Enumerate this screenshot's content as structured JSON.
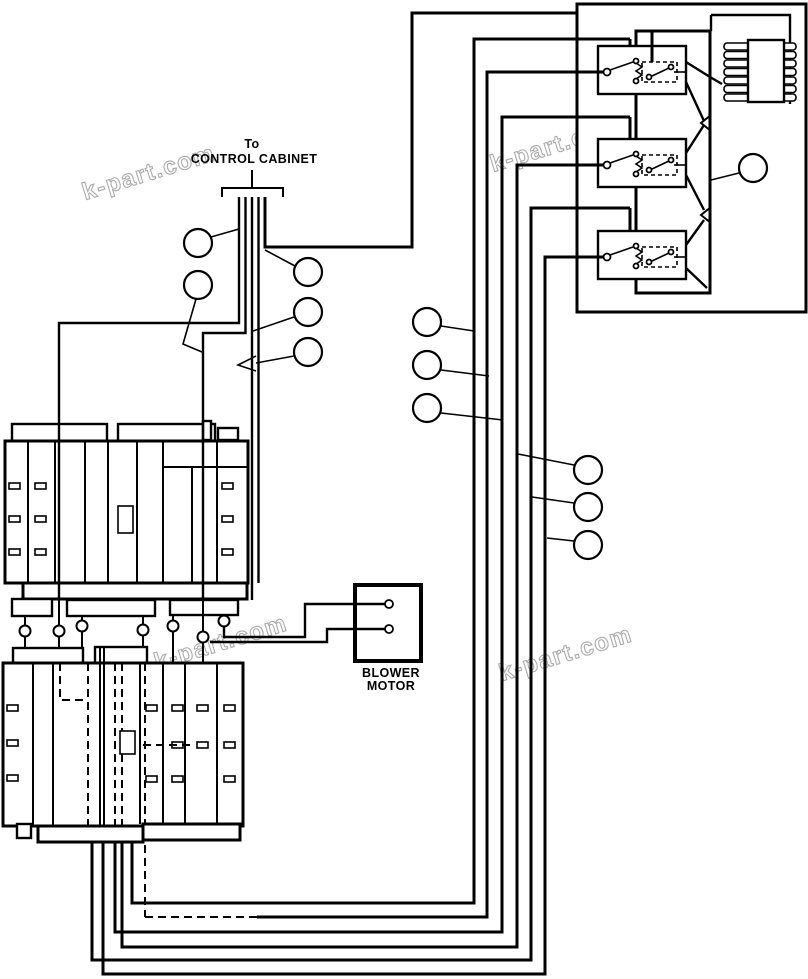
{
  "diagram": {
    "labels": {
      "control_cabinet": {
        "line1": "To",
        "line2": "CONTROL CABINET"
      },
      "blower_motor": {
        "line1": "BLOWER",
        "line2": "MOTOR"
      }
    },
    "watermark": {
      "text": "k-part.com",
      "color": "#ababab",
      "count": 4
    },
    "callouts": {
      "count": 12,
      "label": ""
    },
    "colors": {
      "line": "#000000",
      "background": "#ffffff"
    },
    "components": {
      "control_box": "relay-control-box",
      "relay_count": 3,
      "resistor_block": "finned-resistor-block",
      "heater_upper": "heater-element-bank-upper",
      "heater_lower": "heater-element-bank-lower",
      "motor": "blower-motor"
    }
  }
}
